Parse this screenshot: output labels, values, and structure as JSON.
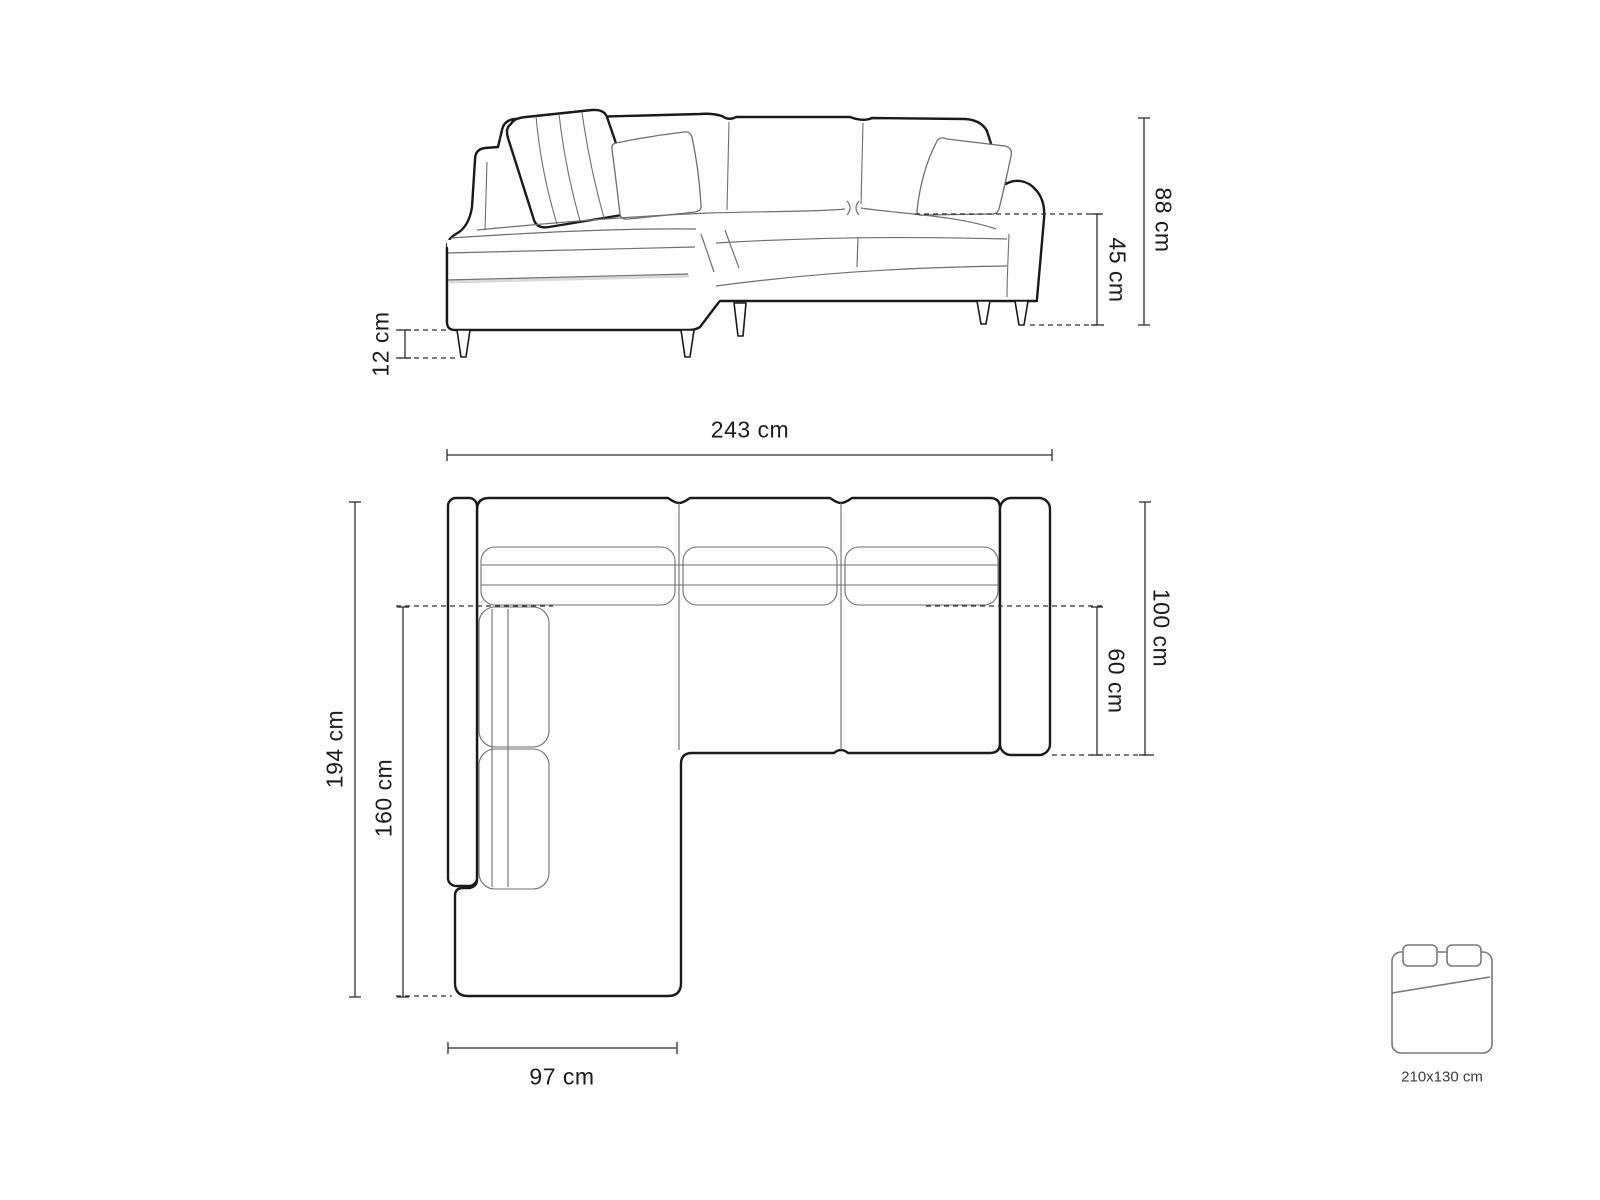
{
  "front_view": {
    "dims": {
      "leg_height": "12 cm",
      "seat_height": "45 cm",
      "total_height": "88 cm"
    }
  },
  "top_view": {
    "dims": {
      "total_width": "243 cm",
      "total_depth": "194 cm",
      "chaise_depth": "160 cm",
      "chaise_width": "97 cm",
      "body_depth": "100 cm",
      "seat_depth": "60 cm"
    }
  },
  "sleeping_area": {
    "size_label": "210x130 cm"
  },
  "colors": {
    "outline": "#1a1a1a",
    "detail": "#6f6f6f",
    "dimension": "#2e2e2e",
    "bed_icon": "#7a7a7a",
    "label_text": "#1c1c1c",
    "bed_text": "#3c3c3c",
    "shadow": "#d9d9d9",
    "background": "#ffffff"
  }
}
